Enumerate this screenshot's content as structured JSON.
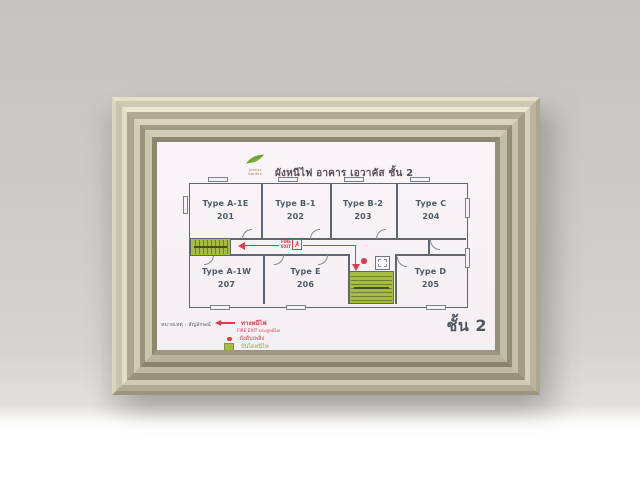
{
  "sign": {
    "logo_text": "Arecas Garden",
    "title": "ผังหนีไฟ อาคาร เอวาคัส ชั้น 2",
    "floor_badge": "ชั้น 2",
    "rooms": [
      {
        "type": "Type A-1E",
        "number": "201"
      },
      {
        "type": "Type B-1",
        "number": "202"
      },
      {
        "type": "Type B-2",
        "number": "203"
      },
      {
        "type": "Type C",
        "number": "204"
      },
      {
        "type": "Type A-1W",
        "number": "207"
      },
      {
        "type": "Type E",
        "number": "206"
      },
      {
        "type": "Type D",
        "number": "205"
      }
    ],
    "corridor_sign": {
      "line1": "FIRE",
      "line2": "EXIT"
    },
    "legend": {
      "note": "หมายเหตุ : สัญลักษณ์",
      "items": [
        {
          "symbol": "red-arrow",
          "label": "ทางหนีไฟ",
          "sublabel": "FIRE EXIT ประตูหนีไฟ"
        },
        {
          "symbol": "red-dot",
          "label": "ถังดับเพลิง"
        },
        {
          "symbol": "green-square",
          "label": "บันไดหนีไฟ"
        }
      ]
    },
    "colors": {
      "escape_route_red": "#e03a4e",
      "stair_green": "#a7bc43",
      "wall_line_gray": "#5e6672",
      "frame_champagne": "#c3bea6",
      "print_background": "#f6f1f5"
    }
  }
}
